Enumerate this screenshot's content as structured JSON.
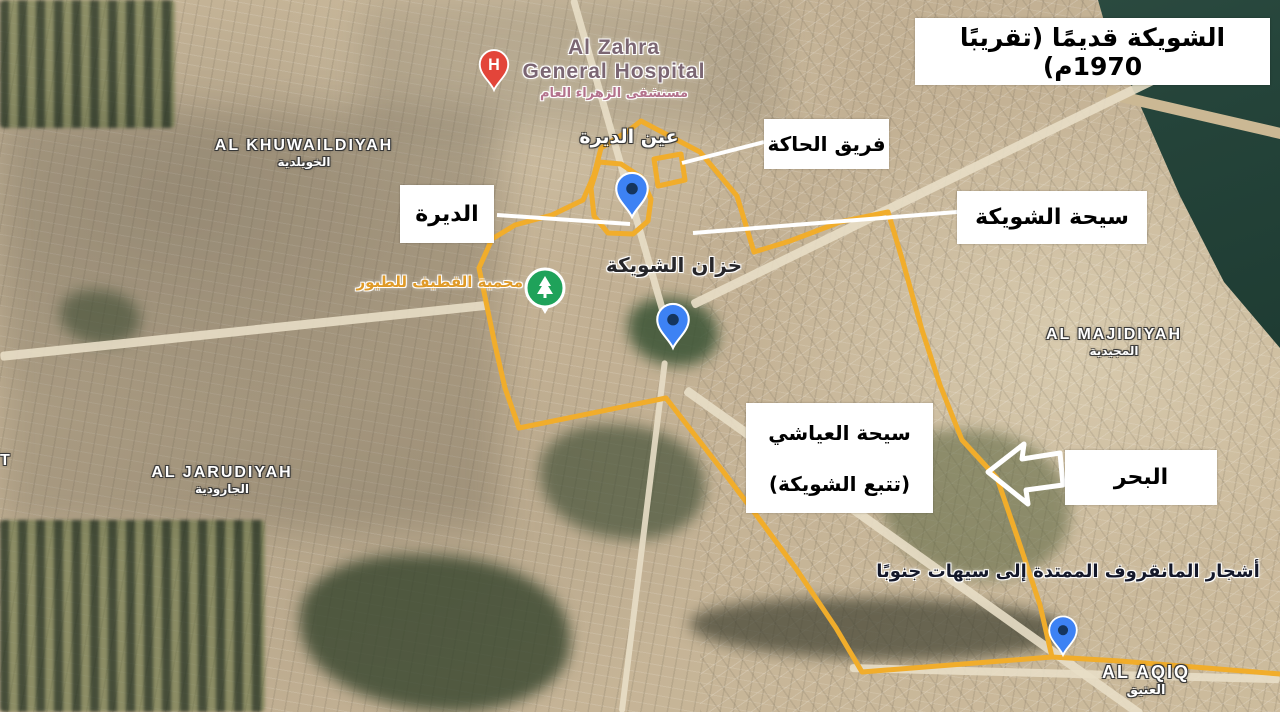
{
  "annotations": {
    "title": "الشويكة قديمًا (تقريبًا 1970م)",
    "haka": "فريق الحاكة",
    "deera": "الديرة",
    "shuwaika_seeha": "سيحة الشويكة",
    "ayashi_line1": "سيحة العياشي",
    "ayashi_line2": "(تتبع الشويكة)",
    "sea": "البحر",
    "mangrove": "أشجار المانقروف الممتدة إلى سيهات جنوبًا"
  },
  "map_labels": {
    "hospital_en1": "Al Zahra",
    "hospital_en2": "General Hospital",
    "hospital_ar": "مستشفى الزهراء العام",
    "hospital_pin_letter": "H",
    "ain_deera": "عين الديرة",
    "khazan": "خزان الشويكة",
    "reserve": "محمية القطيف للطيور",
    "khuwaildiyah_en": "AL KHUWAILDIYAH",
    "khuwaildiyah_ar": "الخويلدية",
    "jarudiyah_en": "AL JARUDIYAH",
    "jarudiyah_ar": "الجارودية",
    "majidiyah_en": "AL MAJIDIYAH",
    "majidiyah_ar": "المجيدية",
    "aqiq_en": "AL AQIQ",
    "aqiq_ar": "العتيق",
    "edge_partial": "T"
  },
  "icons": {
    "hospital_pin": "red-hospital-pin",
    "reserve_pin": "green-tree-pin",
    "place_pins": "blue-map-pin",
    "direction_arrow": "left-arrow"
  },
  "colors": {
    "boundary_yellow": "#F1AD2B",
    "pin_blue": "#3D82F4",
    "pin_blue_dot": "#15355E",
    "hospital_red": "#E3453A",
    "reserve_green": "#1FA25A",
    "water_green": "#25443A",
    "annotation_bg": "#FFFFFF",
    "annotation_text": "#000000"
  }
}
